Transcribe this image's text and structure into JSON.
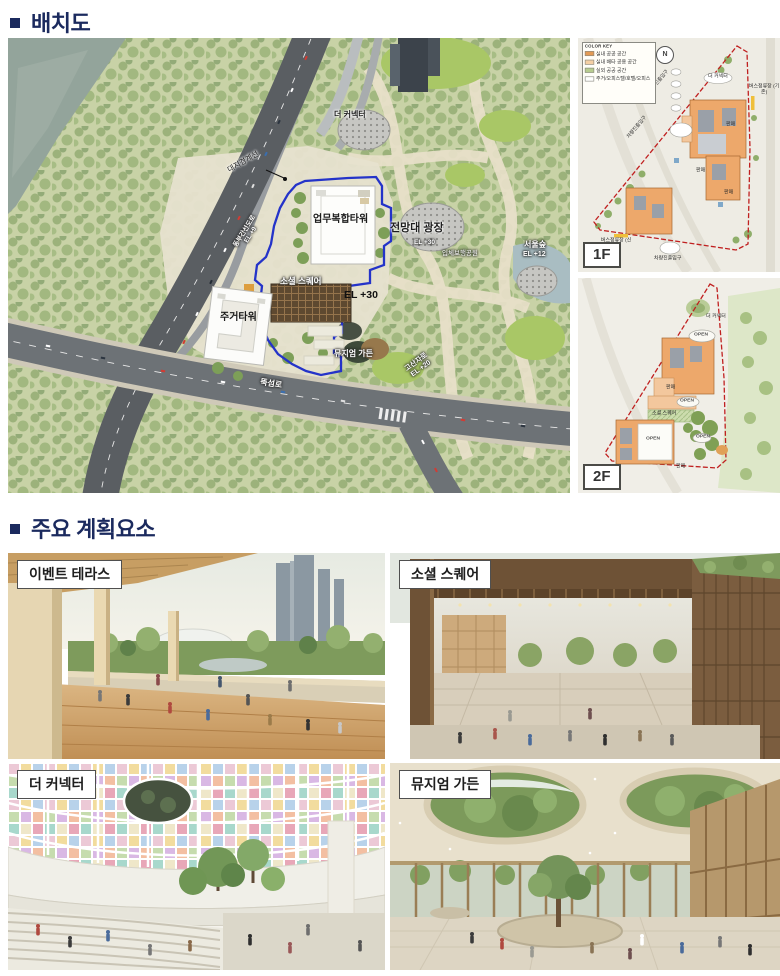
{
  "page": {
    "accent": "#1b2a5e",
    "background": "#ffffff"
  },
  "sections": {
    "site_plan_title": "배치도",
    "key_elements_title": "주요 계획요소"
  },
  "site_plan": {
    "labels": {
      "the_connector": "더 커넥터",
      "site_boundary": "대지경계선",
      "office_tower": "업무복합타워",
      "observatory_plaza": "전망대 광장",
      "observatory_el": "EL +30",
      "seoul_forest": "서울숲",
      "seoul_forest_el": "EL +12",
      "pedestrian_park": "입체보행공원",
      "social_square": "소셜 스퀘어",
      "site_el": "EL +30",
      "residential_tower": "주거타워",
      "museum_garden": "뮤지엄 가든",
      "dongbu_expressway": "동부간선도로",
      "dongbu_el": "EL +9",
      "ttukseom_ro": "뚝섬로",
      "gosanja_ro": "고산자로",
      "gosanja_el": "EL +20"
    }
  },
  "floor_plans": {
    "f1": {
      "tag": "1F",
      "legend_title": "COLOR KEY",
      "north_label": "N",
      "legend": [
        {
          "color": "#e39a55",
          "label": "실내 공공 공간"
        },
        {
          "color": "#f4cfa4",
          "label": "실내 배타 공용 공간"
        },
        {
          "color": "#b7cc8f",
          "label": "실외 공공 공간"
        },
        {
          "color": "#ffffff",
          "label": "주거/오피스텔/호텔/오피스"
        }
      ],
      "labels": {
        "connector": "더 커넥터",
        "vehicle_entry": "차량진출입구",
        "bus_stop_new": "버스정류장 (신규)",
        "bus_stop_existing": "버스정류장 (기존)",
        "retail": "판매"
      }
    },
    "f2": {
      "tag": "2F",
      "labels": {
        "open": "OPEN",
        "connector": "더 커넥터",
        "social_square": "소셜 스퀘어",
        "retail": "판매"
      }
    }
  },
  "gallery": {
    "items": [
      {
        "label": "이벤트 테라스"
      },
      {
        "label": "소셜 스퀘어"
      },
      {
        "label": "더 커넥터"
      },
      {
        "label": "뮤지엄 가든"
      }
    ]
  }
}
